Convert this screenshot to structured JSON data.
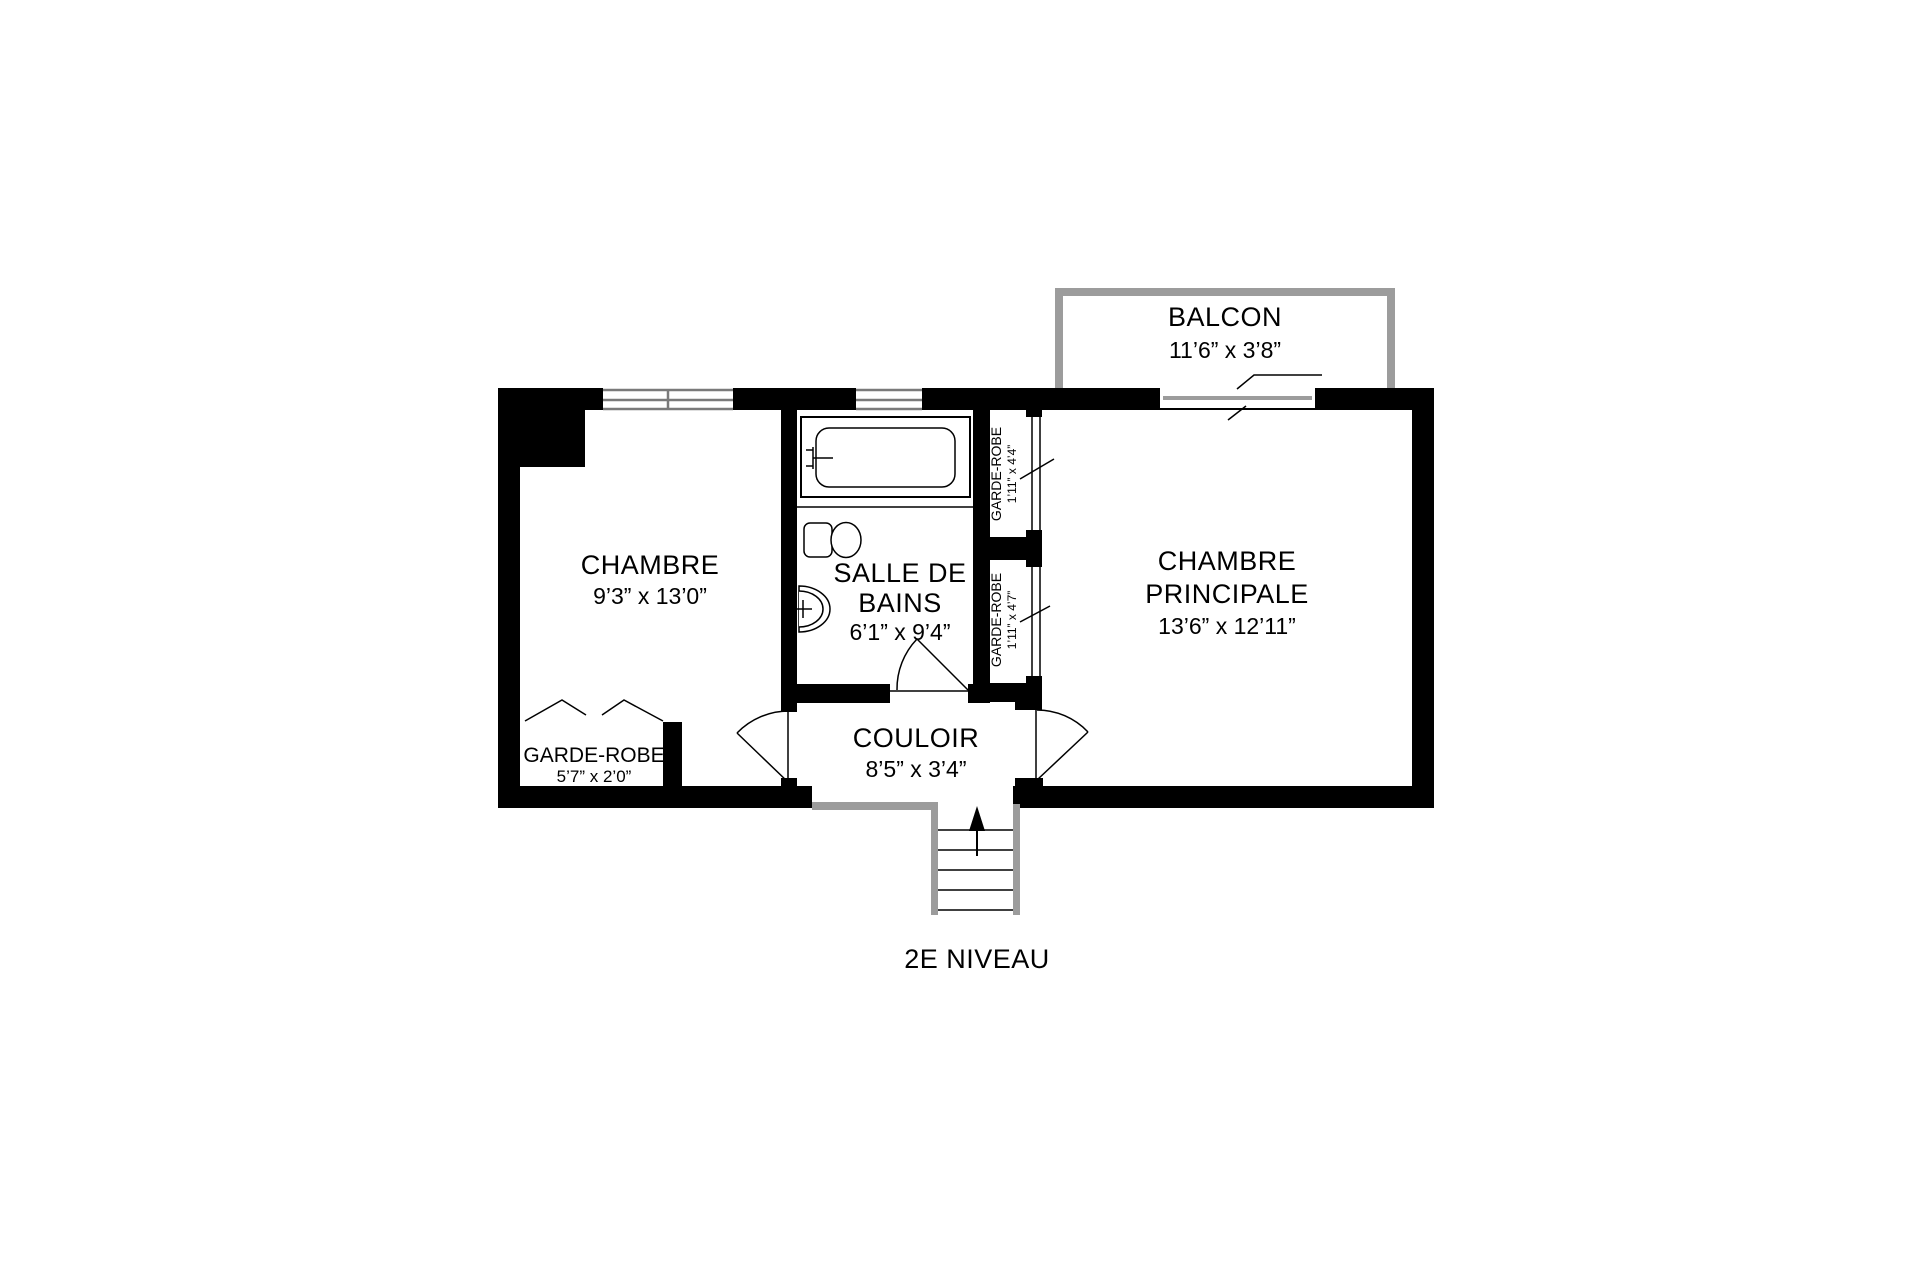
{
  "plan": {
    "floor_label": "2E NIVEAU",
    "rooms": {
      "balcon": {
        "label": "BALCON",
        "dims": "11’6” x 3’8”"
      },
      "chambre": {
        "label": "CHAMBRE",
        "dims": "9’3” x 13’0”"
      },
      "salle_de_bains": {
        "label_line1": "SALLE DE",
        "label_line2": "BAINS",
        "dims": "6’1” x 9’4”"
      },
      "chambre_principale": {
        "label_line1": "CHAMBRE",
        "label_line2": "PRINCIPALE",
        "dims": "13’6” x 12’11”"
      },
      "couloir": {
        "label": "COULOIR",
        "dims": "8’5” x 3’4”"
      },
      "garde_robe_haut": {
        "label": "GARDE-ROBE",
        "dims": "1’11” x 4’4”"
      },
      "garde_robe_bas": {
        "label": "GARDE-ROBE",
        "dims": "1’11” x 4’7”"
      },
      "garde_robe_chambre": {
        "label": "GARDE-ROBE",
        "dims": "5’7” x 2’0”"
      }
    }
  },
  "colors": {
    "wall": "#000000",
    "gray": "#9c9c9c",
    "window": "#7a7a7a",
    "line": "#000000",
    "background": "#ffffff"
  }
}
